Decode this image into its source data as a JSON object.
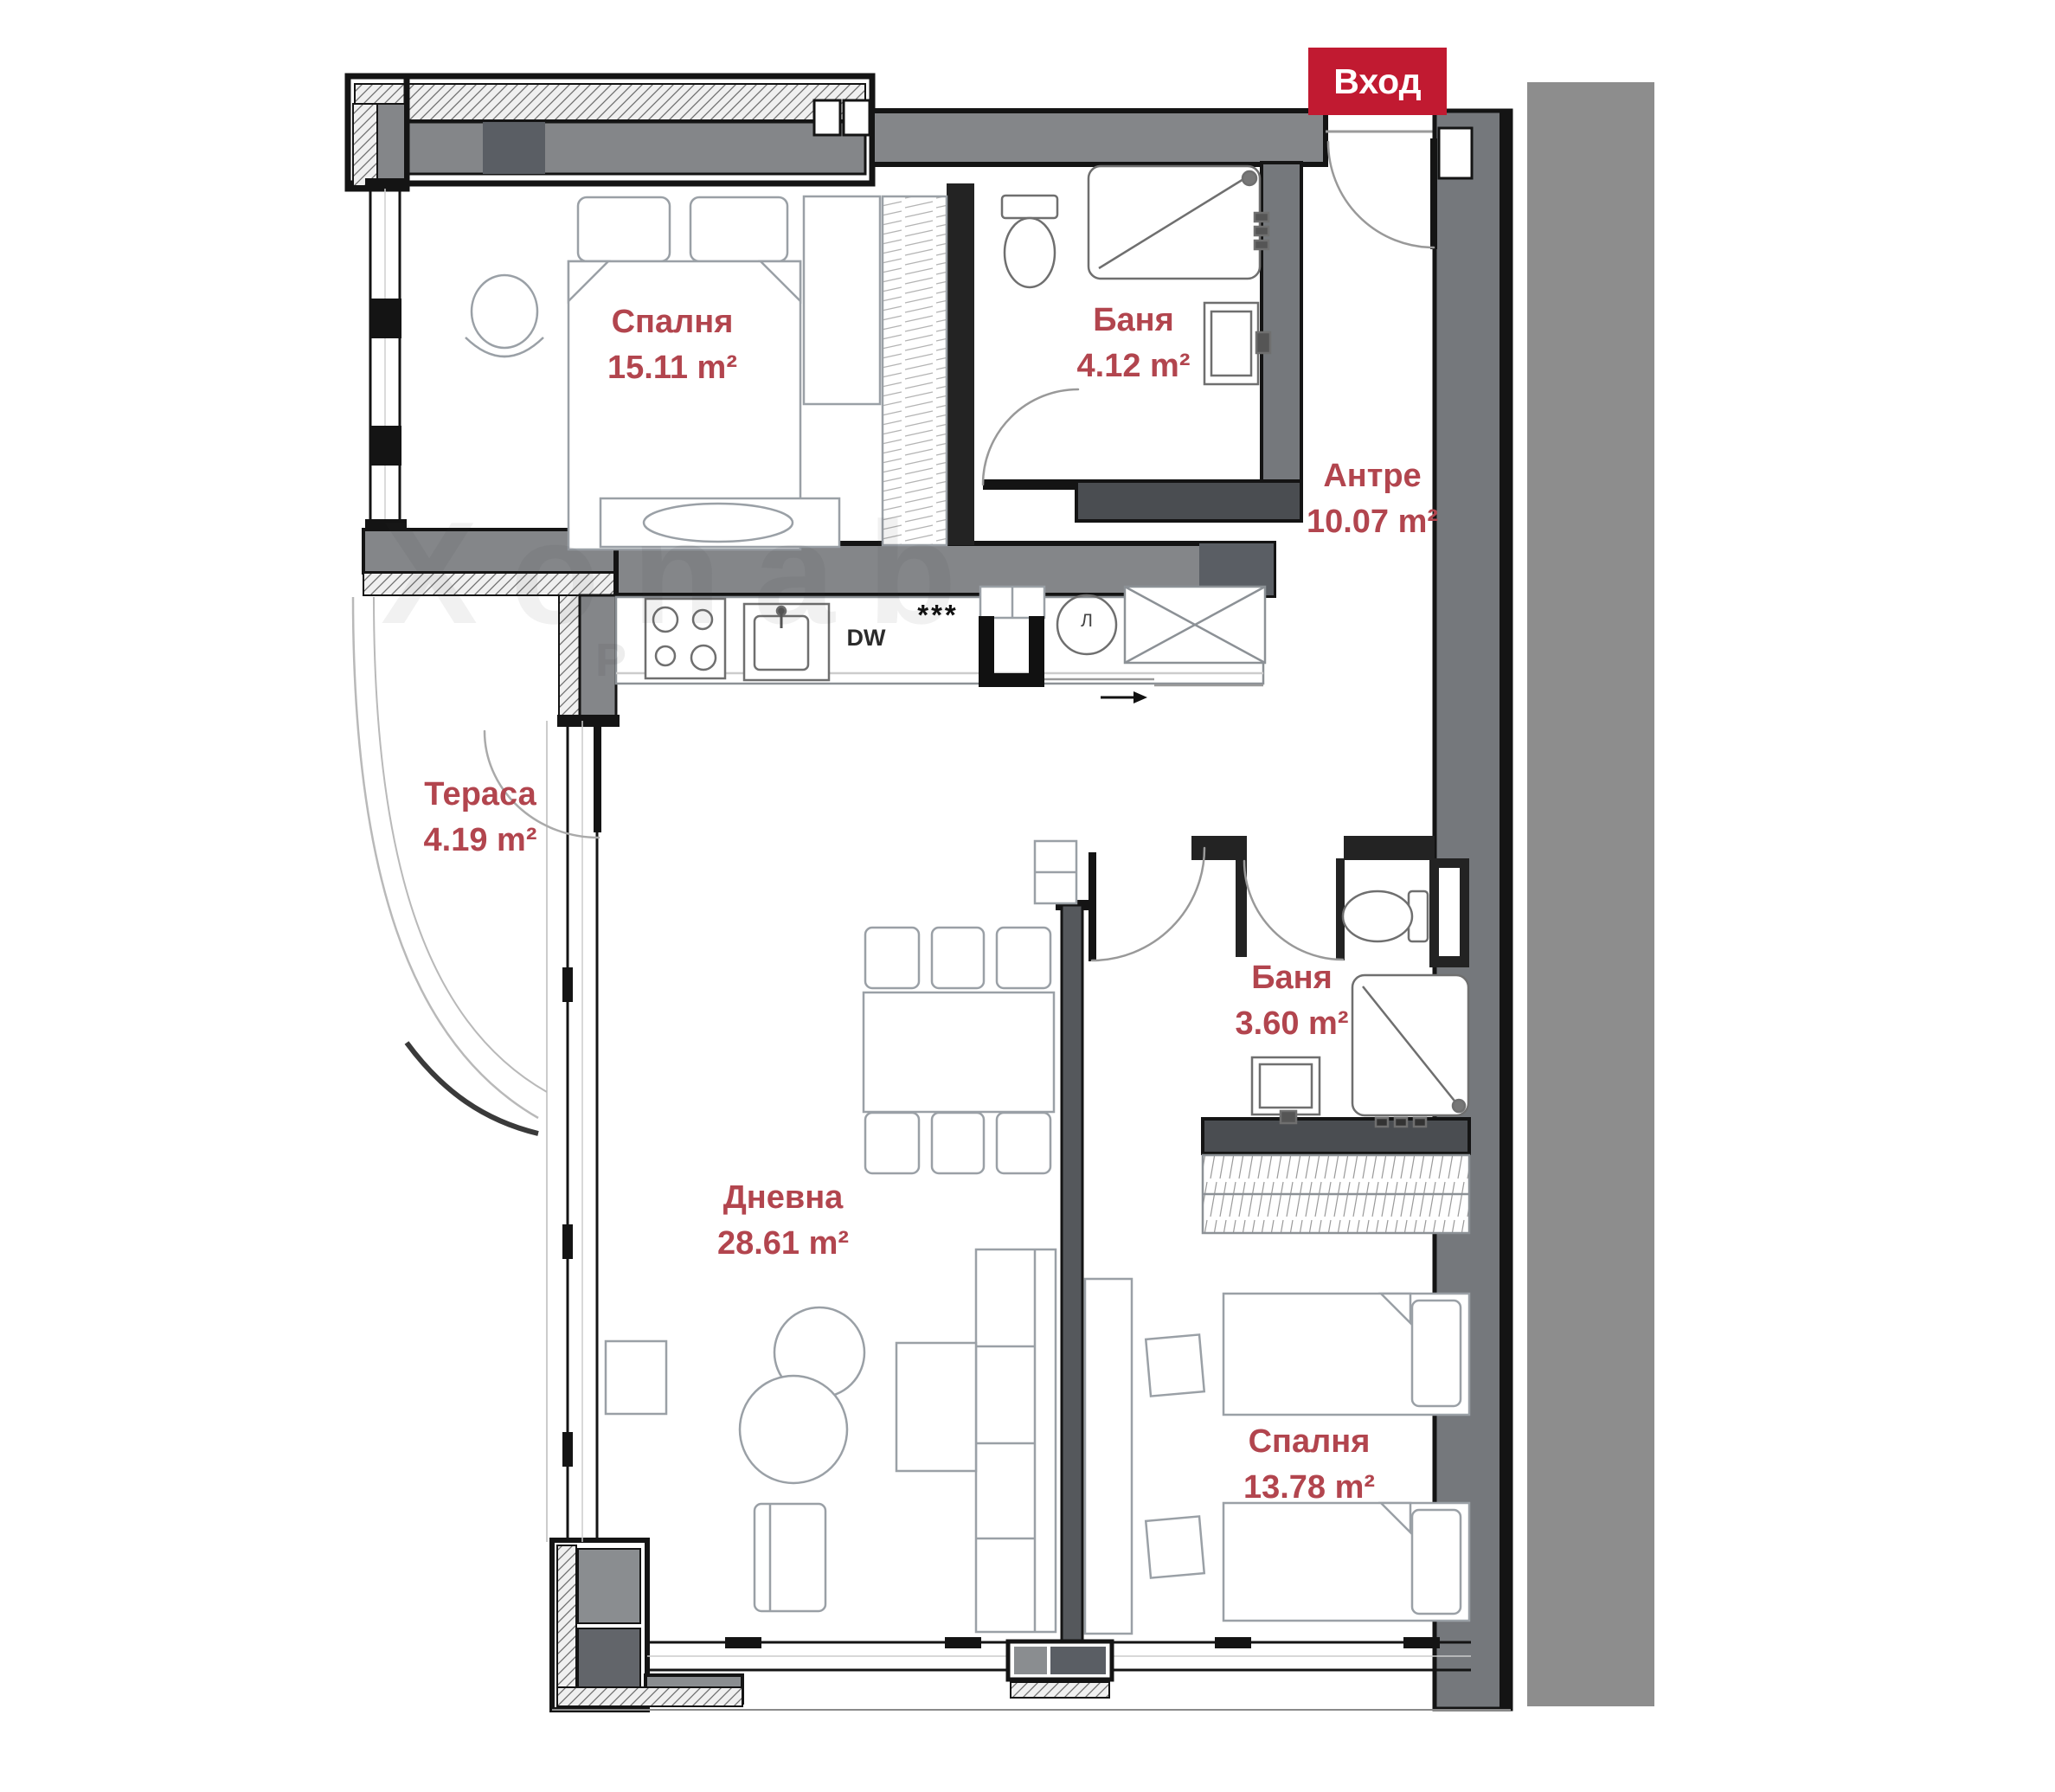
{
  "entrance": {
    "label": "Вход"
  },
  "rooms": {
    "bedroom1": {
      "name": "Спалня",
      "area": "15.11 m²"
    },
    "bathroom1": {
      "name": "Баня",
      "area": "4.12 m²"
    },
    "hallway": {
      "name": "Антре",
      "area": "10.07 m²"
    },
    "terrace": {
      "name": "Тераса",
      "area": "4.19 m²"
    },
    "bathroom2": {
      "name": "Баня",
      "area": "3.60 m²"
    },
    "living": {
      "name": "Дневна",
      "area": "28.61 m²"
    },
    "bedroom2": {
      "name": "Спалня",
      "area": "13.78 m²"
    }
  },
  "kitchen": {
    "dishwasher_label": "DW",
    "freezer_label": "***",
    "appliance_label": "Л"
  },
  "watermark": {
    "main": "Хonab",
    "sub": "P"
  },
  "colors": {
    "accent_red": "#c11a31",
    "label_red": "#b2454e",
    "wall_gray": "#848689",
    "wall_dark": "#5a5e64",
    "side_band": "#8d8d8d"
  }
}
